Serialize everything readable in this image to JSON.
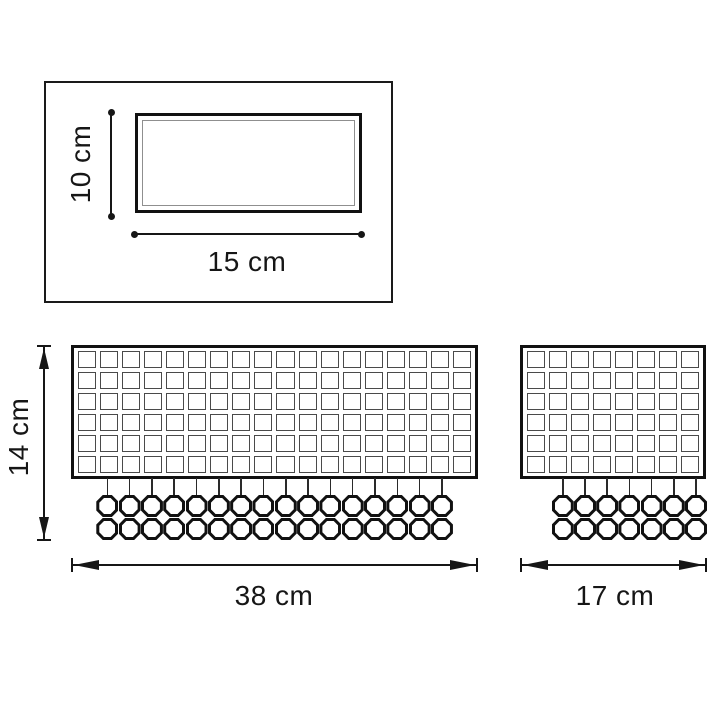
{
  "drawing": {
    "type": "technical-dimension-drawing",
    "colors": {
      "line": "#161616",
      "panel_border": "#111111",
      "grid_line": "#4a4a4a",
      "inner_outline": "#8f8f8f",
      "background": "#ffffff"
    }
  },
  "top_view": {
    "height_label": "10 cm",
    "width_label": "15 cm"
  },
  "front_view_large": {
    "width_label": "38 cm",
    "height_label": "14 cm",
    "grid_columns": 18,
    "grid_rows": 6,
    "crystal_columns": 16,
    "crystal_rows": 2
  },
  "front_view_small": {
    "width_label": "17 cm",
    "grid_columns": 8,
    "grid_rows": 6,
    "crystal_columns": 7,
    "crystal_rows": 2
  }
}
